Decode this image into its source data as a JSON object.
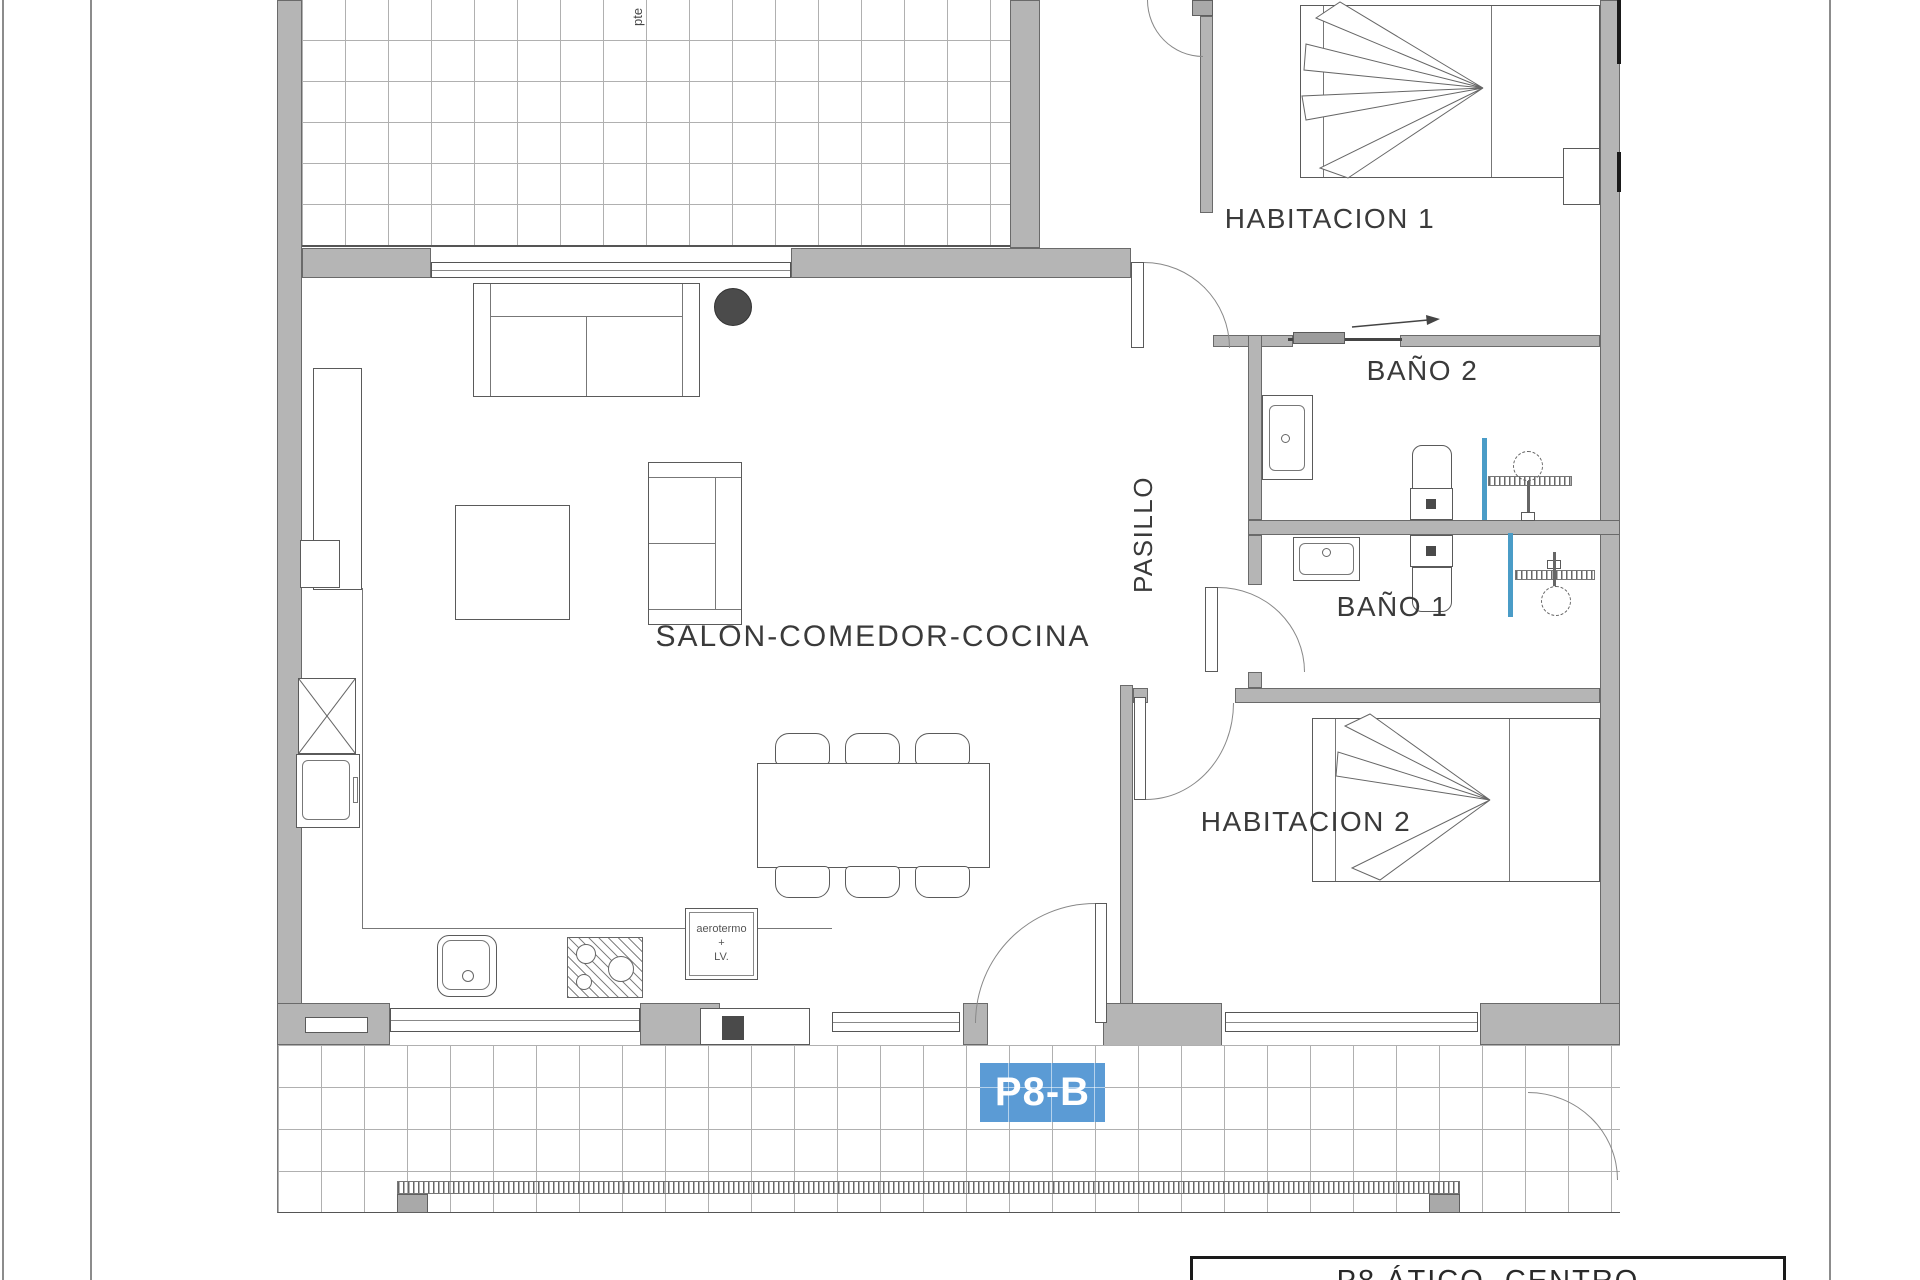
{
  "rooms": {
    "salon": "SALON-COMEDOR-COCINA",
    "pasillo": "PASILLO",
    "hab1": "HABITACION 1",
    "hab2": "HABITACION 2",
    "bano2": "BAÑO 2",
    "bano1": "BAÑO 1"
  },
  "labels": {
    "unit_badge": "P8-B",
    "aerotermo_line1": "aerotermo",
    "aerotermo_line2": "+",
    "aerotermo_line3": "LV.",
    "slope": "pte",
    "title_block": "P8 ÁTICO  CENTRO"
  },
  "colors": {
    "wall_fill": "#b5b5b5",
    "wall_edge": "#6a6a6a",
    "badge_bg": "#5b9bd5",
    "badge_text": "#ffffff",
    "shower_glass": "#4a9cc7",
    "label_text": "#3a3a3a"
  }
}
